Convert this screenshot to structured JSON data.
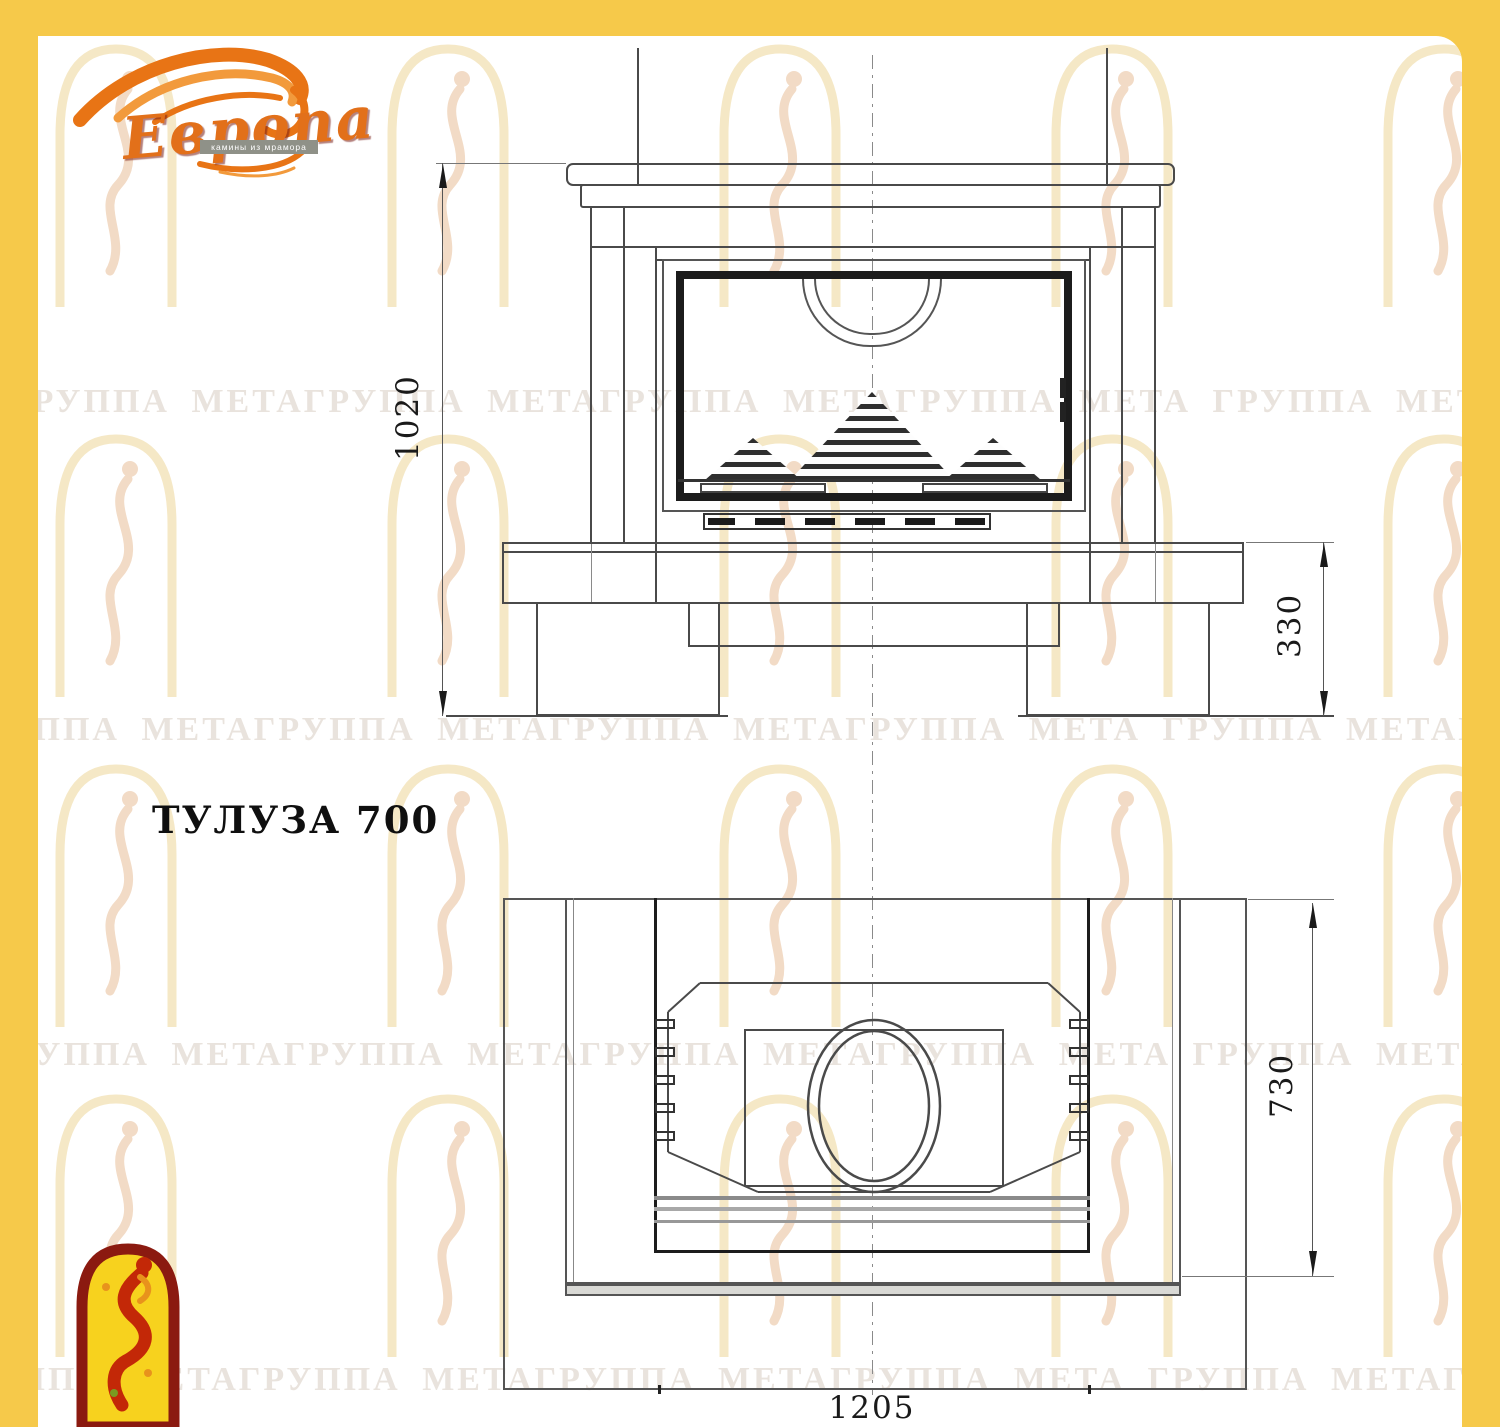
{
  "brand": {
    "name": "Европа",
    "tagline": "камины из мрамора"
  },
  "title": "ТУЛУЗА 700",
  "watermark_text": "ГРУППА МЕТАГРУППА МЕТАГРУППА МЕТАГРУППА МЕТА",
  "dimensions": {
    "front_height": "1020",
    "base_height": "330",
    "depth": "730",
    "width": "1205"
  },
  "colors": {
    "border": "#F6C94A",
    "line": "#4a4a4a",
    "dark_frame": "#1c1c1c",
    "brand_orange": "#E2701A",
    "brand_red": "#8B1A10",
    "logo_yellow": "#F7D21E",
    "logo_red": "#C32807"
  }
}
